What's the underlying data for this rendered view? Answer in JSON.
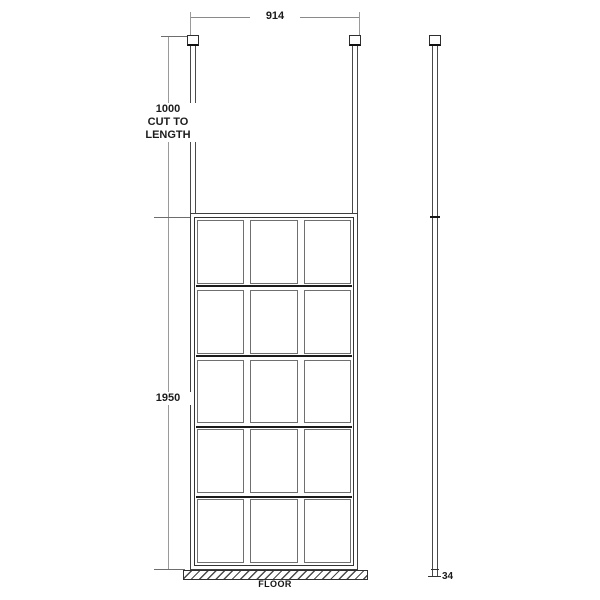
{
  "diagram": {
    "labels": {
      "width": "914",
      "post_line1": "1000",
      "post_line2": "CUT TO",
      "post_line3": "LENGTH",
      "height": "1950",
      "depth": "34",
      "floor": "FLOOR"
    },
    "grid": {
      "columns": 3,
      "rows": 5
    },
    "colors": {
      "line": "#3f3f3f",
      "dim_line": "#9a9a9a",
      "text": "#1c1c1c",
      "background": "#ffffff"
    }
  }
}
